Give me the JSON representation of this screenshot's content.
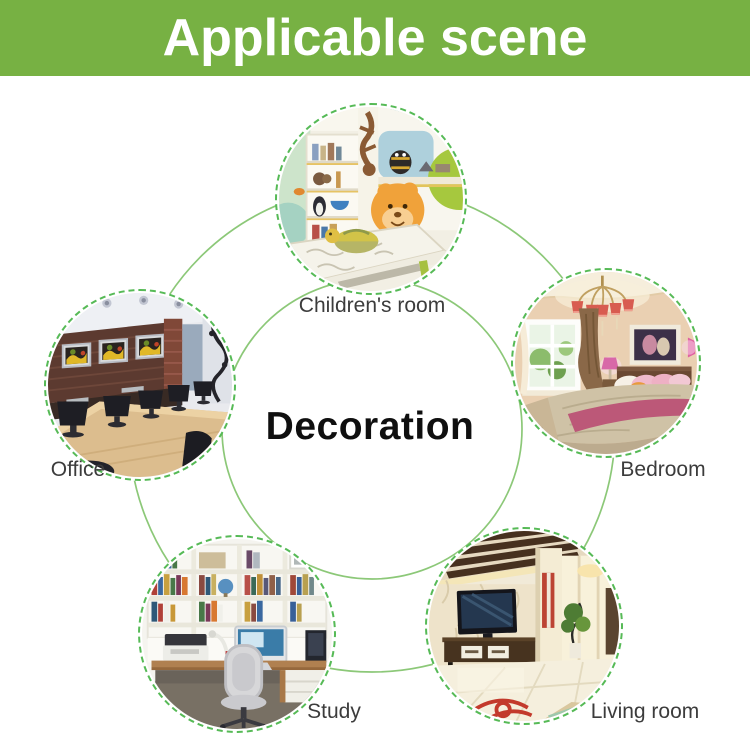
{
  "banner": {
    "title": "Applicable scene"
  },
  "center_label": "Decoration",
  "scenes": [
    {
      "id": "children-room",
      "label": "Children's room"
    },
    {
      "id": "office",
      "label": "Office"
    },
    {
      "id": "bedroom",
      "label": "Bedroom"
    },
    {
      "id": "study",
      "label": "Study"
    },
    {
      "id": "living-room",
      "label": "Living room"
    }
  ],
  "colors": {
    "banner_bg": "#77b143",
    "banner_text": "#ffffff",
    "ring_line": "#8cc878",
    "circle_dash": "#56ba56",
    "label_text": "#3c3c3c",
    "center_text": "#0f0f0f"
  }
}
